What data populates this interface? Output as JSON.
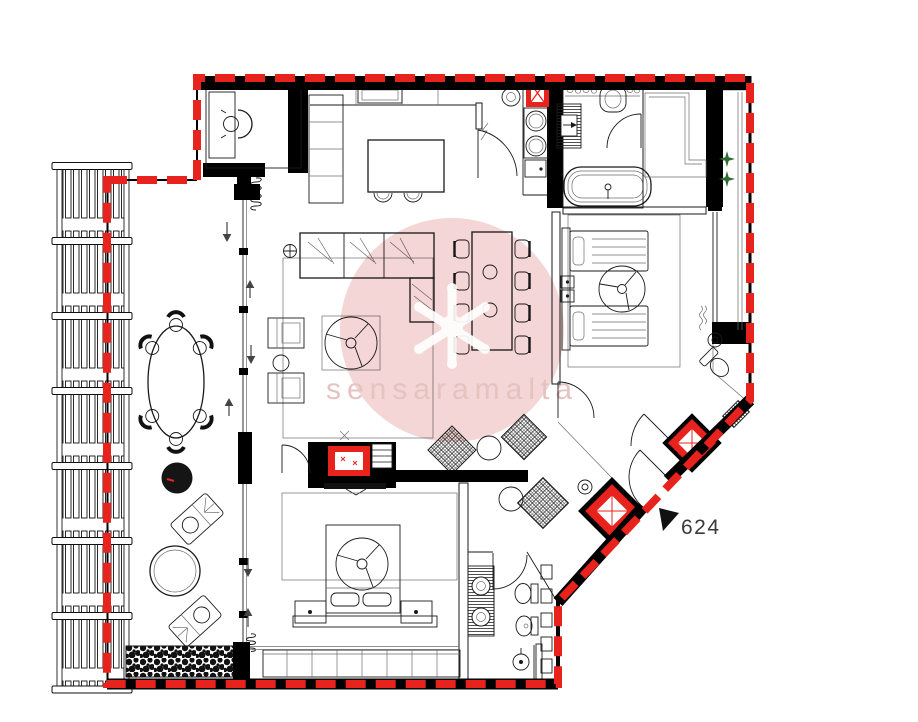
{
  "plan": {
    "unit_label": "624",
    "watermark": {
      "text": "sensaramalta"
    }
  },
  "colors": {
    "paper": "#ffffff",
    "wall-black": "#000000",
    "line": "#1a1a1a",
    "soft-line": "#6e6e6e",
    "boundary-red": "#e8231d",
    "fire-red": "#e8231d",
    "plant-green": "#2f6b33",
    "watermark-pink": "#f1cfce",
    "watermark-ink": "#dfb9b6"
  }
}
